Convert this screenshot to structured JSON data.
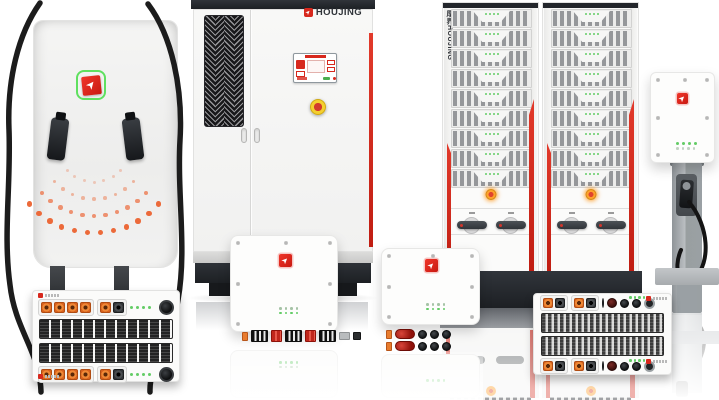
{
  "brand": {
    "name": "HOUJING",
    "vertical_label": "厚界HOUJING",
    "arrow_glyph": "➤"
  },
  "palette": {
    "accent_red": "#d7281d",
    "logo_red": "#e2251b",
    "logo_ring_green": "#5fe05f",
    "led_green": "#63cc66",
    "signal_orange": "#ec6a3a",
    "dark_base": "#23262b"
  },
  "dc_charger": {
    "arc_dots": {
      "cx": 66,
      "cy": -16,
      "start_deg": 42,
      "end_deg": 138,
      "color": "#ec6a3a",
      "name": "signal-dot",
      "arcs": [
        {
          "radius": 36,
          "count": 7,
          "size": 3,
          "opacity": 0.3
        },
        {
          "radius": 53,
          "count": 9,
          "size": 3.5,
          "opacity": 0.45
        },
        {
          "radius": 70,
          "count": 11,
          "size": 4.5,
          "opacity": 0.7
        },
        {
          "radius": 87,
          "count": 12,
          "size": 5.5,
          "opacity": 1
        }
      ]
    }
  },
  "rack_cabinet": {
    "modules": 9,
    "leds_per_module": 4,
    "led_color": "#63cc66"
  },
  "rectifier_left": {
    "group_a": [
      "orange",
      "orange",
      "orange",
      "orange"
    ],
    "group_b": [
      "orange",
      "black"
    ],
    "leds": {
      "count": 4,
      "size": 3,
      "gap": 3,
      "color": "#63cc66",
      "name": "status-led"
    }
  },
  "rectifier_right": {
    "pair_1": [
      "orange",
      "black"
    ],
    "pair_2": [
      "orange",
      "black"
    ],
    "rounds": [
      "round-darkred",
      "round-black",
      "round-black",
      "round-ring"
    ],
    "leds": {
      "count": 4,
      "size": 2.5,
      "gap": 2,
      "color": "#63cc66",
      "name": "status-led"
    }
  },
  "terminal_row": [
    "mini-orange",
    "stripe",
    "red",
    "stripe",
    "red",
    "stripe",
    "mini-gray",
    "mini-black"
  ],
  "plug_row": [
    "mini-orange",
    "big-red",
    "round-black",
    "round-black",
    "round-black"
  ],
  "inverter_panel": {
    "leds_row1": {
      "count": 4,
      "size": 2.5,
      "gap": 3,
      "color": "#a6c3a6",
      "name": "status-led"
    },
    "leds_row2": {
      "count": 4,
      "size": 2.5,
      "gap": 3,
      "color": "#63cc66",
      "name": "status-led"
    }
  },
  "wallbox": {
    "leds_row1": {
      "count": 4,
      "size": 3,
      "gap": 3,
      "color": "#63cc66",
      "name": "status-led"
    },
    "leds_row2": {
      "count": 4,
      "size": 2.5,
      "gap": 3,
      "color": "#c3d2c4",
      "name": "status-led"
    }
  }
}
